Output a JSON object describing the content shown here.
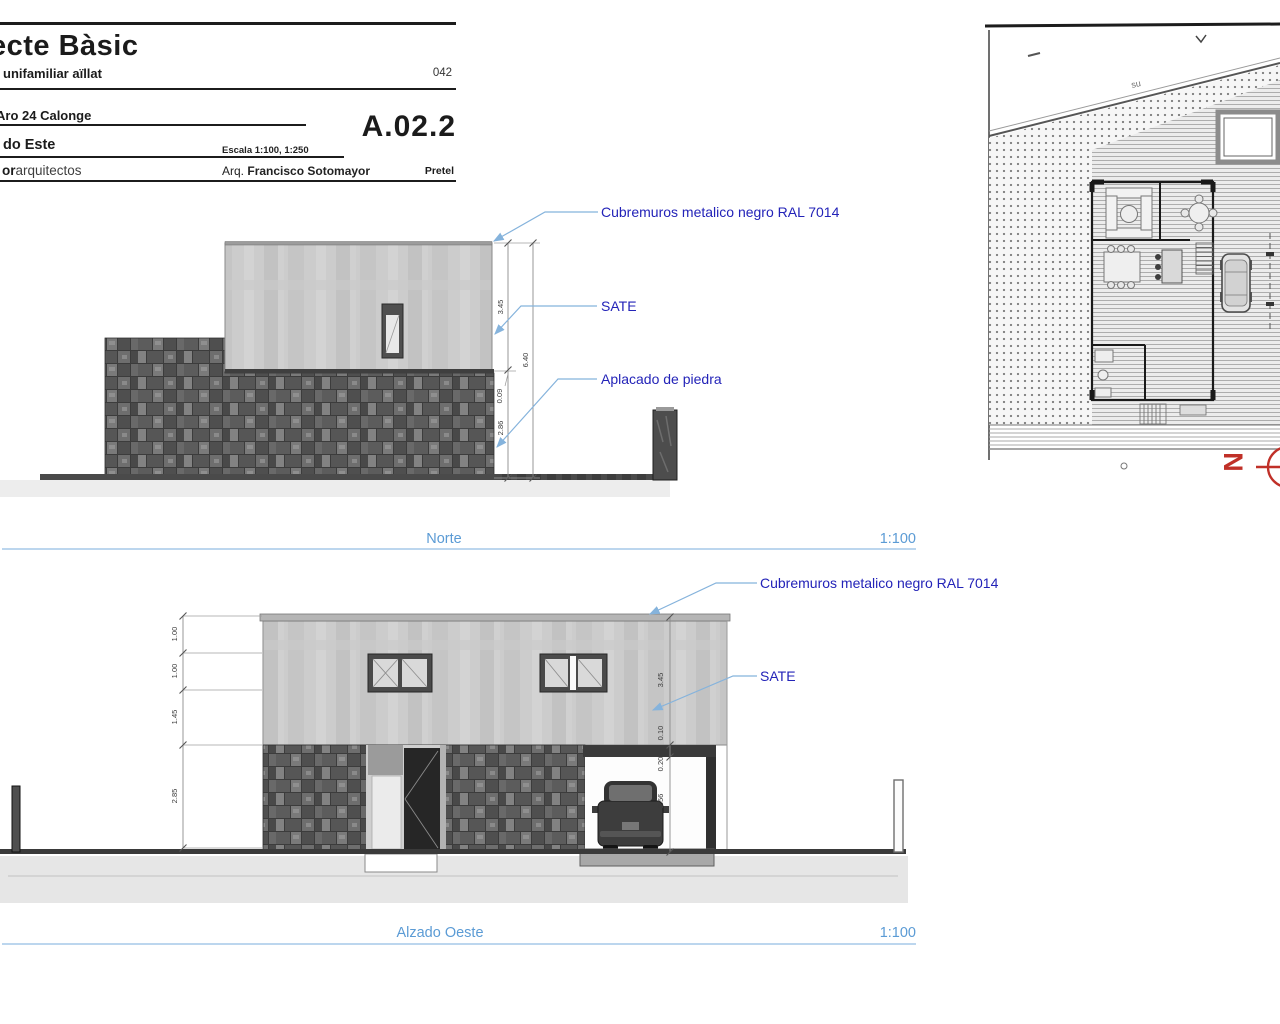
{
  "title_block": {
    "line1": "ecte Bàsic",
    "line2": "unifamiliar aïllat",
    "number": "042",
    "location": "Aro 24 Calonge",
    "code": "A.02.2",
    "view": "do Este",
    "scale_note": "Escala 1:100, 1:250",
    "firm_bold": "or",
    "firm_rest": "arquitectos",
    "architect_prefix": "Arq.",
    "architect_name": "Francisco Sotomayor",
    "client": "Pretel"
  },
  "north": {
    "caption": "Norte",
    "scale": "1:100",
    "ann_cubremuros": "Cubremuros metalico negro RAL 7014",
    "ann_sate": "SATE",
    "ann_aplacado": "Aplacado de piedra",
    "dims": [
      "3.45",
      "0.09",
      "2.86",
      "6.40"
    ]
  },
  "west": {
    "caption": "Alzado Oeste",
    "scale": "1:100",
    "ann_cubremuros": "Cubremuros metalico negro RAL 7014",
    "ann_sate": "SATE",
    "dims_left": [
      "1.00",
      "1.00",
      "1.45",
      "2.85"
    ],
    "dims_right": [
      "3.45",
      "0.10",
      "0.20",
      "2.56"
    ]
  },
  "site_plan": {
    "north_letter": "N",
    "slope_label": "su"
  },
  "colors": {
    "annotation_text": "#2323b8",
    "leader_line": "#85b3dc",
    "caption_blue": "#5b9bd5",
    "north_arrow_red": "#c03028",
    "stone_gray": "#5c5c5c",
    "sate_gray": "#cccccc"
  }
}
